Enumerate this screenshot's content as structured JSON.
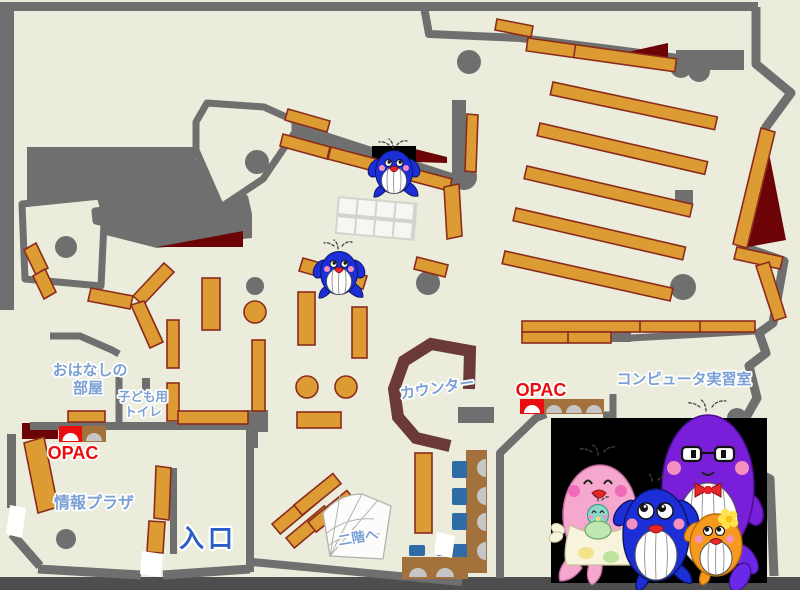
{
  "labels": {
    "storytelling_room_1": "おはなしの",
    "storytelling_room_2": "部屋",
    "kids_toilet_1": "子ども用",
    "kids_toilet_2": "トイレ",
    "opac_left": "OPAC",
    "info_plaza": "情報プラザ",
    "entrance": "入口",
    "counter": "カウンター",
    "opac_center": "OPAC",
    "computer_room": "コンピュータ実習室",
    "to_second_floor": "二階へ"
  },
  "colors": {
    "floor": "#EBECDB",
    "wall": "#6F6F6F",
    "shelf": "#DD9C33",
    "shelf_border": "#8B2B1B",
    "dark_red": "#6C0407",
    "counter": "#6B3A38",
    "furniture_brown": "#A3713B",
    "chair_blue": "#2F6BA7",
    "seat_grey": "#C6C6C6",
    "label_blue": "#7AA0D4",
    "entrance_blue": "#2B5FC7",
    "opac_red": "#E90D0D",
    "bottom_bar": "#4E4E4E",
    "black_panel": "#000000",
    "stairs": "#FCFCFA",
    "grid_grout": "#D4D4CC",
    "grid_cell": "#F6F6F2",
    "whale_blue": "#1C2FD6",
    "whale_pink": "#F6A7CE",
    "whale_purple": "#7A1FD9",
    "whale_orange": "#F59A1F",
    "baby_teal": "#8FD8C8"
  },
  "mascots": {
    "on_map": [
      "blue-whale",
      "blue-whale"
    ],
    "family_panel": [
      "pink-whale-mother-with-baby",
      "blue-whale-child",
      "purple-whale-father",
      "orange-whale-child"
    ]
  }
}
